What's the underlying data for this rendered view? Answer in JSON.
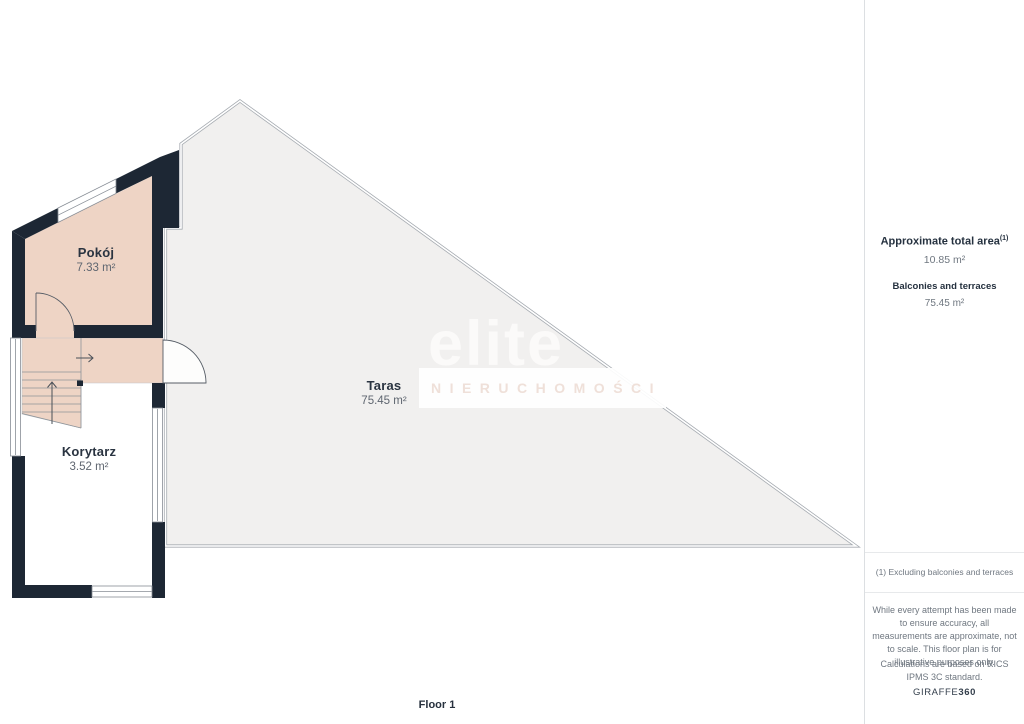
{
  "floor_label": "Floor 1",
  "rooms": {
    "pokoj": {
      "name": "Pokój",
      "area": "7.33 m²"
    },
    "taras": {
      "name": "Taras",
      "area": "75.45 m²"
    },
    "korytarz": {
      "name": "Korytarz",
      "area": "3.52 m²"
    }
  },
  "sidebar": {
    "total_area_label": "Approximate total area",
    "total_area_superscript": "(1)",
    "total_area_value": "10.85 m²",
    "balconies_label": "Balconies and terraces",
    "balconies_value": "75.45 m²",
    "footnote": "(1) Excluding balconies and terraces",
    "disclaimer": "While every attempt has been made to ensure accuracy, all measurements are approximate, not to scale. This floor plan is for illustrative purposes only.",
    "calculations": "Calculations are based on RICS IPMS 3C standard.",
    "brand_name": "GIRAFFE",
    "brand_suffix": "360"
  },
  "watermark": {
    "title": "elite",
    "subtitle": "NIERUCHOMOŚCI"
  },
  "colors": {
    "wall": "#1d2734",
    "room_fill": "#eed4c5",
    "terrace_fill": "#f1f0ef",
    "terrace_outline": "#a6abb1",
    "text_dark": "#26303d",
    "text_gray": "#6f7780",
    "watermark_title": "#fbfaf9",
    "watermark_subtitle": "#efe0d9"
  }
}
